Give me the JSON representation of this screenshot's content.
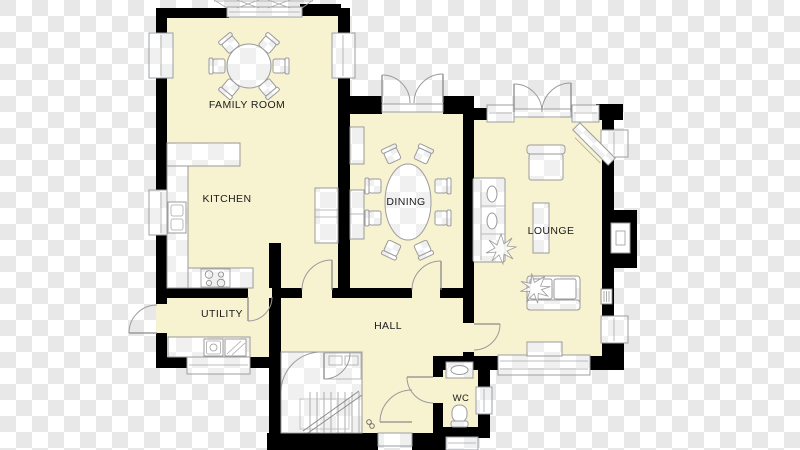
{
  "rooms": {
    "family_room": "FAMILY ROOM",
    "kitchen": "KITCHEN",
    "dining": "DINING",
    "lounge": "LOUNGE",
    "utility": "UTILITY",
    "hall": "HALL",
    "wc": "WC"
  },
  "colors": {
    "floor": "#f7f2d0",
    "wall": "#000000",
    "furniture_outline": "#9b9b9b",
    "checker_light": "#ffffff",
    "checker_dark": "#e8e8e8"
  },
  "fixtures": [
    "round-table-with-chairs",
    "kitchen-counter",
    "kitchen-sink",
    "hob",
    "tall-unit",
    "dining-table-with-chairs",
    "sofa",
    "armchair",
    "tv-unit",
    "coffee-table",
    "sideboard",
    "plant",
    "fireplace-flue",
    "radiator",
    "washing-machine",
    "utility-counter",
    "staircase",
    "wc-sink",
    "toilet"
  ]
}
